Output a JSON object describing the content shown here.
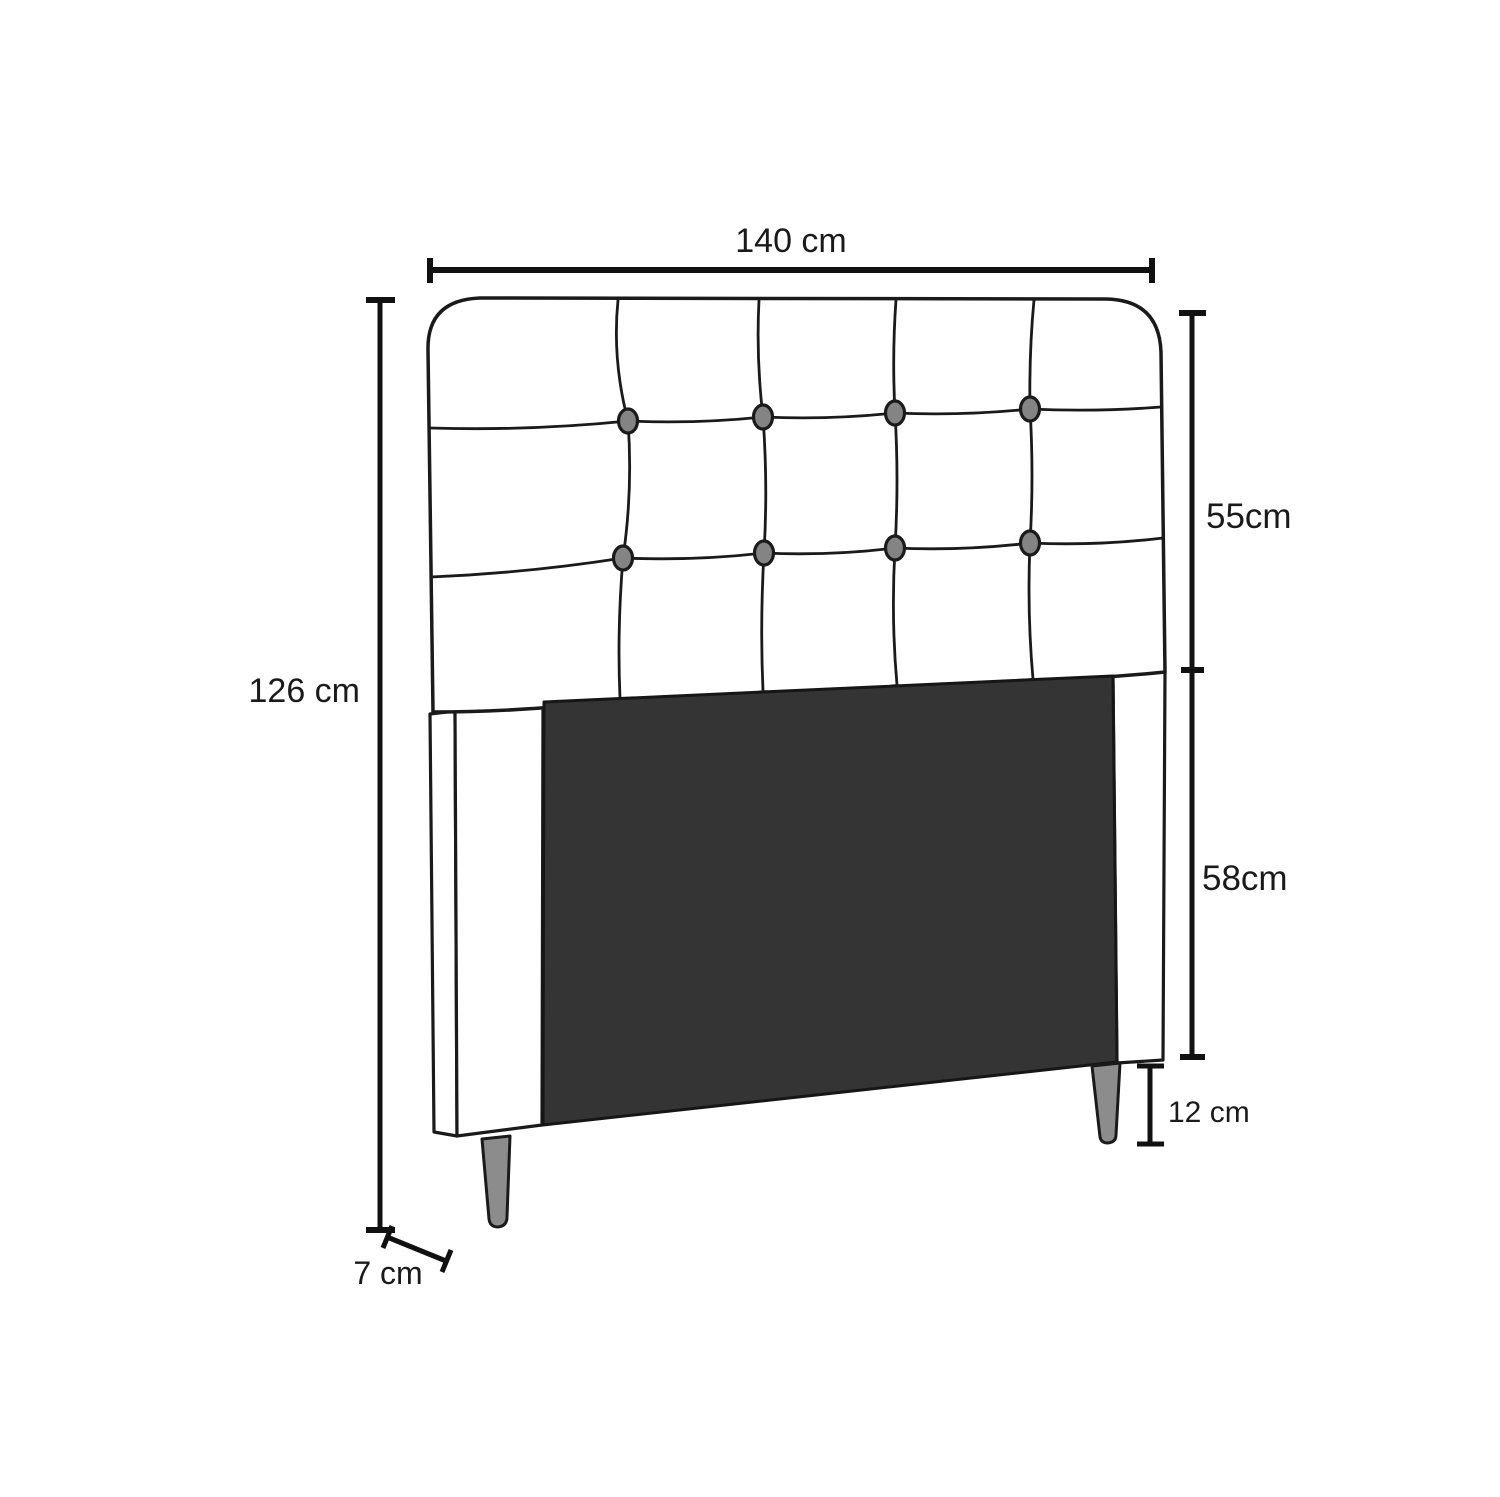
{
  "diagram": {
    "title": "headboard-dimension-diagram",
    "subject": "button-tufted bed headboard, front view with dimension callouts",
    "labels": {
      "width": "140 cm",
      "upper_height": "55cm",
      "lower_height": "58cm",
      "leg_height": "12 cm",
      "total_height": "126 cm",
      "depth": "7 cm"
    },
    "dimensions": {
      "width_cm": 140,
      "upper_section_cm": 55,
      "lower_section_cm": 58,
      "leg_cm": 12,
      "total_height_cm": 126,
      "depth_cm": 7
    },
    "tufting": {
      "columns": 5,
      "rows": 3,
      "button_rows": 2,
      "buttons_per_row": 4
    },
    "colors": {
      "background": "#ffffff",
      "outline": "#1a1a1a",
      "dimension_line": "#111111",
      "panel": "#343434",
      "panel_outline": "#161616",
      "leg": "#8c8c8c",
      "button": "#848484",
      "upholstery": "#ffffff"
    }
  }
}
